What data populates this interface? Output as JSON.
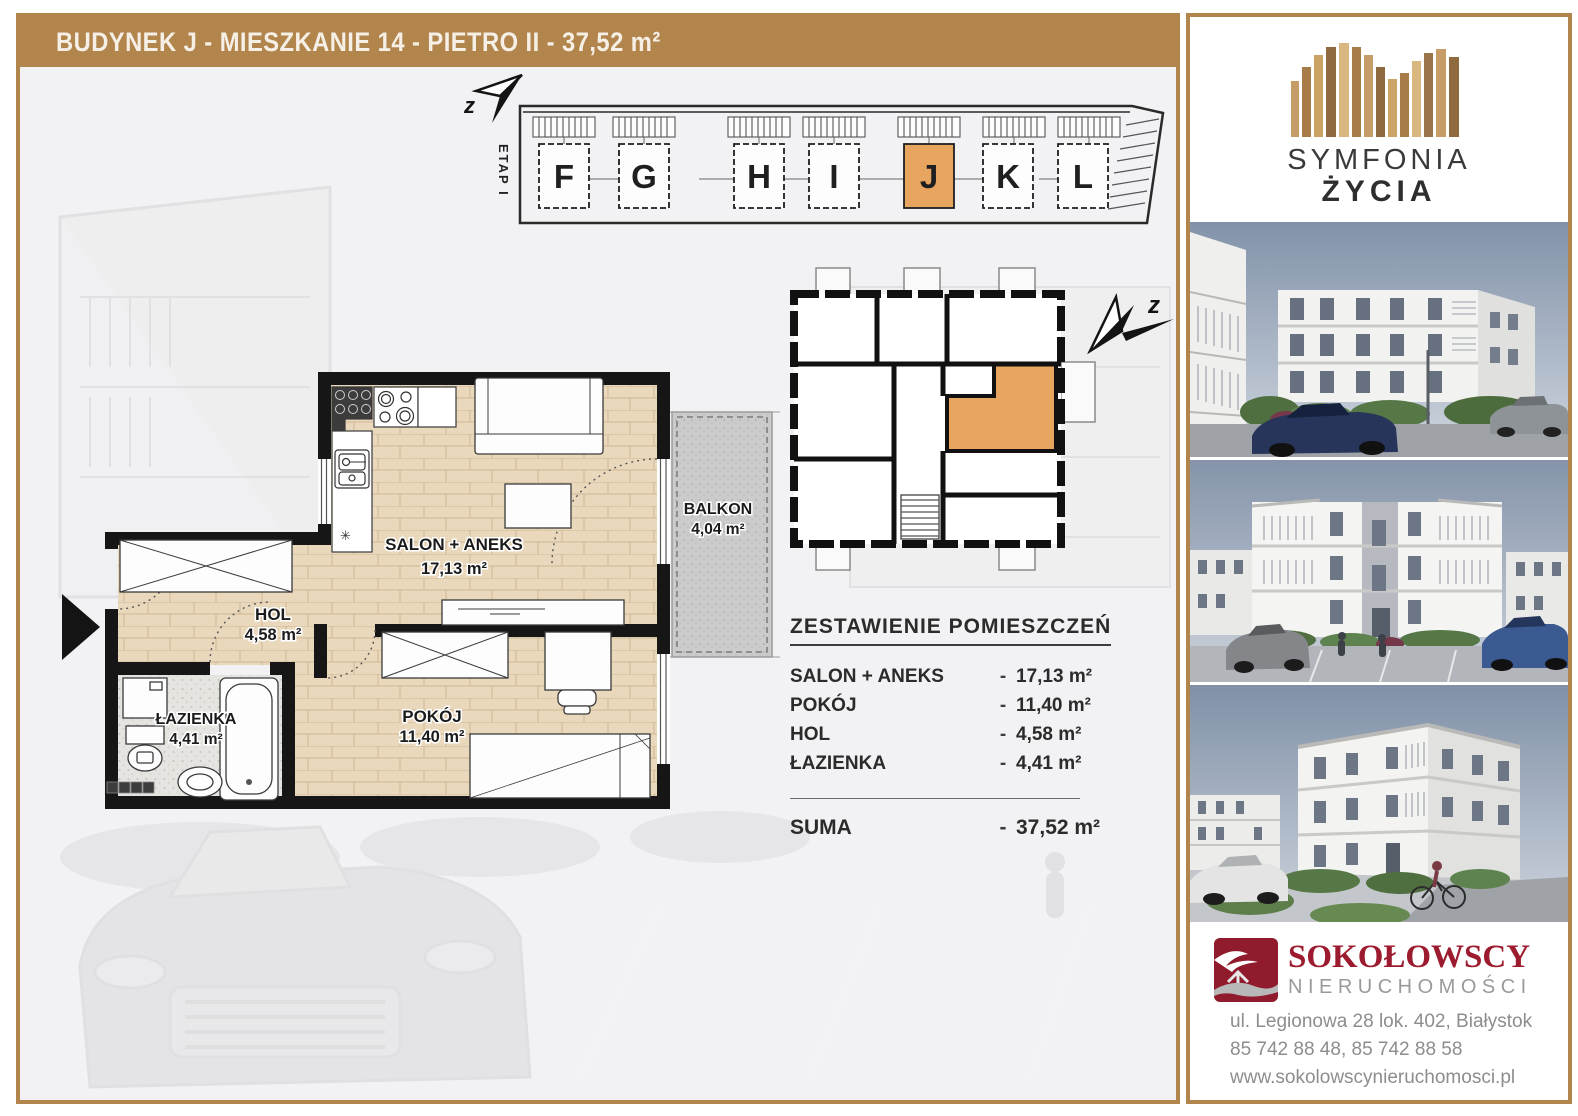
{
  "title": "BUDYNEK J - MIESZKANIE 14 - PIETRO II - 37,52 m²",
  "site_plan": {
    "etap_label": "ETAP I",
    "north_label": "z",
    "buildings": [
      "F",
      "G",
      "H",
      "I",
      "J",
      "K",
      "L"
    ],
    "highlighted_building": "J"
  },
  "floor_plan": {
    "rooms": [
      {
        "name": "SALON + ANEKS",
        "area": "17,13 m²"
      },
      {
        "name": "HOL",
        "area": "4,58 m²"
      },
      {
        "name": "ŁAZIENKA",
        "area": "4,41 m²"
      },
      {
        "name": "POKÓJ",
        "area": "11,40 m²"
      },
      {
        "name": "BALKON",
        "area": "4,04 m²"
      }
    ]
  },
  "summary": {
    "title": "ZESTAWIENIE POMIESZCZEŃ",
    "dash": "-",
    "rows": [
      {
        "label": "SALON + ANEKS",
        "value": "17,13 m²"
      },
      {
        "label": "POKÓJ",
        "value": "11,40 m²"
      },
      {
        "label": "HOL",
        "value": "4,58 m²"
      },
      {
        "label": "ŁAZIENKA",
        "value": "4,41 m²"
      }
    ],
    "total_label": "SUMA",
    "total_value": "37,52 m²"
  },
  "sidebar": {
    "brand": {
      "name_line1": "SYMFONIA",
      "name_line2": "ŻYCIA",
      "location": "Białystok, ul. Produkcyjna"
    },
    "agency": {
      "name": "SOKOŁOWSCY",
      "subtitle": "NIERUCHOMOŚCI",
      "address": "ul. Legionowa 28 lok. 402, Białystok",
      "phones": "85 742 88 48,  85 742 88 58",
      "website": "www.sokolowscynieruchomosci.pl"
    }
  },
  "colors": {
    "accent_brown": "#B2854D",
    "highlight_orange": "#E8A55F",
    "agency_red": "#9C1B2E",
    "plan_wall": "#161616"
  }
}
